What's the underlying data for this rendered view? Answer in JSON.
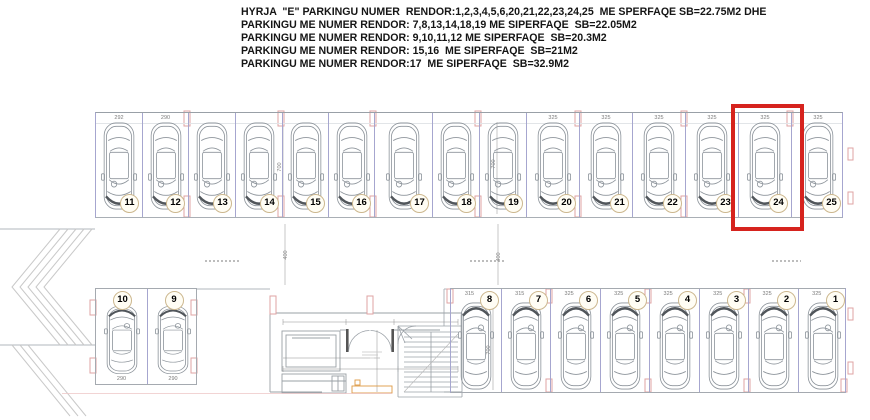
{
  "header": {
    "lines": [
      "HYRJA  \"E\" PARKINGU NUMER  RENDOR:1,2,3,4,5,6,20,21,22,23,24,25  ME SPERFAQE SB=22.75M2 DHE",
      "PARKINGU ME NUMER RENDOR: 7,8,13,14,18,19 ME SIPERFAQE  SB=22.05M2",
      "PARKINGU ME NUMER RENDOR: 9,10,11,12 ME SIPERFAQE  SB=20.3M2",
      "PARKINGU ME NUMER RENDOR: 15,16  ME SIPERFAQE  SB=21M2",
      "PARKINGU ME NUMER RENDOR:17  ME SIPERFAQE  SB=32.9M2"
    ]
  },
  "plan": {
    "top_row": {
      "stalls": [
        {
          "num": "11",
          "dim": "292"
        },
        {
          "num": "12",
          "dim": "290"
        },
        {
          "num": "13",
          "dim": ""
        },
        {
          "num": "14",
          "dim": ""
        },
        {
          "num": "15",
          "dim": ""
        },
        {
          "num": "16",
          "dim": ""
        },
        {
          "num": "17",
          "dim": ""
        },
        {
          "num": "18",
          "dim": ""
        },
        {
          "num": "19",
          "dim": ""
        },
        {
          "num": "20",
          "dim": "325"
        },
        {
          "num": "21",
          "dim": "325"
        },
        {
          "num": "22",
          "dim": "325"
        },
        {
          "num": "23",
          "dim": "325"
        },
        {
          "num": "24",
          "dim": "325"
        },
        {
          "num": "25",
          "dim": "325"
        }
      ]
    },
    "bottom_left_row": {
      "stalls": [
        {
          "num": "10",
          "dim": "290"
        },
        {
          "num": "9",
          "dim": "290"
        }
      ]
    },
    "bottom_right_row": {
      "stalls": [
        {
          "num": "8",
          "dim": "315"
        },
        {
          "num": "7",
          "dim": "315"
        },
        {
          "num": "6",
          "dim": "325"
        },
        {
          "num": "5",
          "dim": "325"
        },
        {
          "num": "4",
          "dim": "325"
        },
        {
          "num": "3",
          "dim": "325"
        },
        {
          "num": "2",
          "dim": "325"
        },
        {
          "num": "1",
          "dim": "325"
        }
      ]
    },
    "dims": {
      "depth": "700",
      "aisle_width": "400"
    },
    "highlight": {
      "stall": "24",
      "color": "#d6231e"
    }
  },
  "colors": {
    "wall_line": "#99a0a7",
    "stall_separator": "#a6a6cf",
    "car_outline": "#8d949b",
    "column_marker": "#dfa3a3",
    "badge_border": "#ccb78e",
    "highlight_red": "#d6231e",
    "ramp_marking_orange": "#dd9a44"
  }
}
